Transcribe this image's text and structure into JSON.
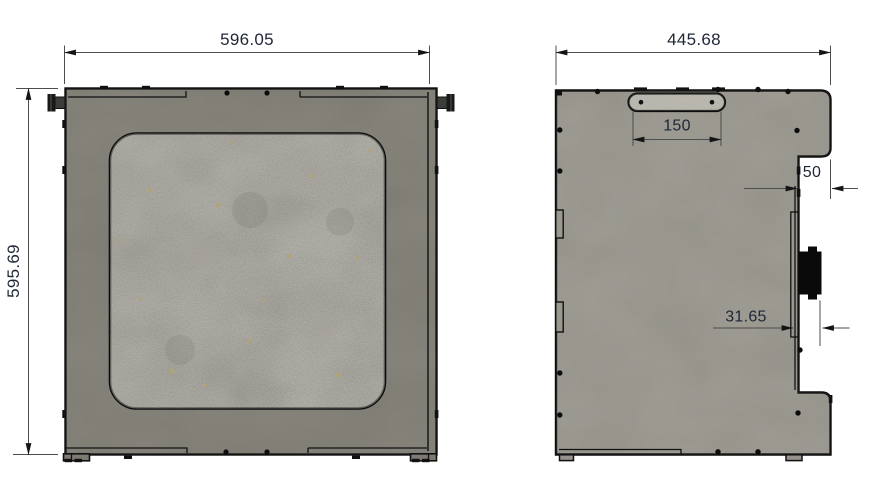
{
  "drawing": {
    "dimensions": {
      "front": {
        "width": "596.05",
        "height": "595.69"
      },
      "side": {
        "width": "445.68",
        "handle_slot": "150",
        "notch": "50",
        "connector_offset": "31.65"
      }
    },
    "colors": {
      "front_panel": "#7c7a71",
      "side_panel": "#95938a",
      "window": "#8f8d85",
      "handle_slot": "#b7b5ac",
      "connector": "#0a0a0a",
      "outline": "#0d0d0d",
      "dimension_line": "#4d4d4d",
      "dimension_text": "#1e2636",
      "background": "#ffffff"
    }
  }
}
